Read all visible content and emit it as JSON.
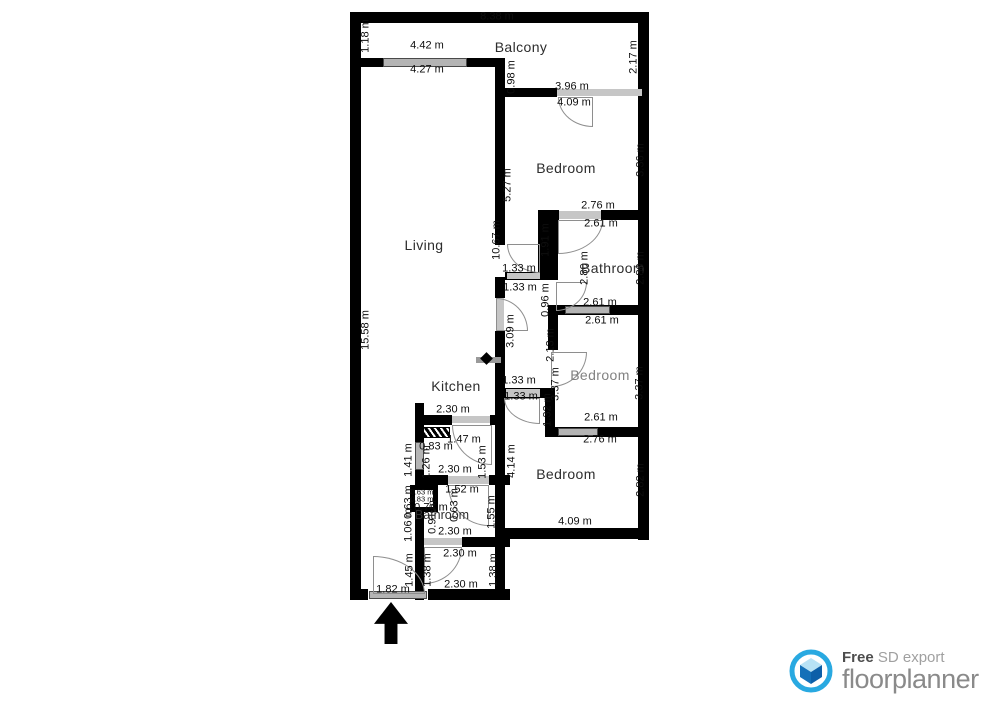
{
  "plan": {
    "labels": [
      {
        "text": "8.38 m",
        "x": 497,
        "y": 17
      },
      {
        "text": "1.18 m",
        "x": 366,
        "y": 36,
        "rot": 1
      },
      {
        "text": "4.42 m",
        "x": 427,
        "y": 46
      },
      {
        "text": "Balcony",
        "x": 521,
        "y": 47,
        "kind": "room"
      },
      {
        "text": "4.27 m",
        "x": 427,
        "y": 70
      },
      {
        "text": "0.98 m",
        "x": 512,
        "y": 77,
        "rot": 1
      },
      {
        "text": "2.17 m",
        "x": 634,
        "y": 57,
        "rot": 1
      },
      {
        "text": "3.96 m",
        "x": 572,
        "y": 87
      },
      {
        "text": "4.09 m",
        "x": 574,
        "y": 103
      },
      {
        "text": "Bedroom",
        "x": 566,
        "y": 168,
        "kind": "room"
      },
      {
        "text": "5.27 m",
        "x": 508,
        "y": 185,
        "rot": 1
      },
      {
        "text": "3.36 m",
        "x": 641,
        "y": 160,
        "rot": 1
      },
      {
        "text": "2.76 m",
        "x": 598,
        "y": 206
      },
      {
        "text": "2.61 m",
        "x": 601,
        "y": 224
      },
      {
        "text": "1.91 m",
        "x": 546,
        "y": 240,
        "rot": 1
      },
      {
        "text": "2.80 m",
        "x": 585,
        "y": 268,
        "rot": 1
      },
      {
        "text": "Bathroom",
        "x": 613,
        "y": 268,
        "kind": "room"
      },
      {
        "text": "2.80 m",
        "x": 641,
        "y": 268,
        "rot": 1
      },
      {
        "text": "10.67 m",
        "x": 497,
        "y": 240,
        "rot": 1
      },
      {
        "text": "1.33 m",
        "x": 519,
        "y": 269
      },
      {
        "text": "1.33 m",
        "x": 520,
        "y": 288
      },
      {
        "text": "2.61 m",
        "x": 600,
        "y": 303
      },
      {
        "text": "2.61 m",
        "x": 602,
        "y": 321
      },
      {
        "text": "0.96 m",
        "x": 546,
        "y": 300,
        "rot": 1
      },
      {
        "text": "3.09 m",
        "x": 511,
        "y": 331,
        "rot": 1
      },
      {
        "text": "2.13 m",
        "x": 551,
        "y": 345,
        "rot": 1
      },
      {
        "text": "15.58 m",
        "x": 366,
        "y": 330,
        "rot": 1
      },
      {
        "text": "Living",
        "x": 424,
        "y": 245,
        "kind": "room"
      },
      {
        "text": "Bedroom",
        "x": 600,
        "y": 375,
        "kind": "room gray"
      },
      {
        "text": "3.37 m",
        "x": 556,
        "y": 384,
        "rot": 1
      },
      {
        "text": "3.37 m",
        "x": 640,
        "y": 383,
        "rot": 1
      },
      {
        "text": "1.33 m",
        "x": 519,
        "y": 381
      },
      {
        "text": "1.33 m",
        "x": 521,
        "y": 397
      },
      {
        "text": "1.32 m",
        "x": 548,
        "y": 410,
        "rot": 1
      },
      {
        "text": "2.61 m",
        "x": 601,
        "y": 418
      },
      {
        "text": "2.76 m",
        "x": 600,
        "y": 440
      },
      {
        "text": "Kitchen",
        "x": 456,
        "y": 386,
        "kind": "room"
      },
      {
        "text": "2.30 m",
        "x": 453,
        "y": 410
      },
      {
        "text": "1.47 m",
        "x": 464,
        "y": 440
      },
      {
        "text": "0.83 m",
        "x": 436,
        "y": 447
      },
      {
        "text": "1.41 m",
        "x": 409,
        "y": 460,
        "rot": 1
      },
      {
        "text": "1.26 m",
        "x": 427,
        "y": 462,
        "rot": 1
      },
      {
        "text": "1.53 m",
        "x": 483,
        "y": 462,
        "rot": 1
      },
      {
        "text": "4.14 m",
        "x": 512,
        "y": 461,
        "rot": 1
      },
      {
        "text": "Bedroom",
        "x": 566,
        "y": 474,
        "kind": "room"
      },
      {
        "text": "2.82 m",
        "x": 641,
        "y": 480,
        "rot": 1
      },
      {
        "text": "2.30 m",
        "x": 455,
        "y": 470
      },
      {
        "text": "1.52 m",
        "x": 462,
        "y": 490
      },
      {
        "text": "0.63 m",
        "x": 455,
        "y": 505,
        "rot": 1
      },
      {
        "text": "1.55 m",
        "x": 492,
        "y": 512,
        "rot": 1
      },
      {
        "text": "0.63 m",
        "x": 409,
        "y": 502,
        "rot": 1
      },
      {
        "text": "1.06 m",
        "x": 409,
        "y": 525,
        "rot": 1
      },
      {
        "text": "0.63 m",
        "x": 422,
        "y": 492,
        "kind": "tiny"
      },
      {
        "text": "0.83 m",
        "x": 422,
        "y": 499,
        "kind": "tiny"
      },
      {
        "text": "0.74 m",
        "x": 431,
        "y": 508
      },
      {
        "text": "0.91 m",
        "x": 433,
        "y": 517,
        "rot": 1
      },
      {
        "text": "Bathroom",
        "x": 442,
        "y": 515,
        "kind": "room-small"
      },
      {
        "text": "2.30 m",
        "x": 455,
        "y": 532
      },
      {
        "text": "4.09 m",
        "x": 575,
        "y": 522
      },
      {
        "text": "2.30 m",
        "x": 460,
        "y": 554
      },
      {
        "text": "1.45 m",
        "x": 410,
        "y": 570,
        "rot": 1
      },
      {
        "text": "1.38 m",
        "x": 428,
        "y": 570,
        "rot": 1
      },
      {
        "text": "1.38 m",
        "x": 494,
        "y": 570,
        "rot": 1
      },
      {
        "text": "2.30 m",
        "x": 461,
        "y": 585
      },
      {
        "text": "1.82 m",
        "x": 393,
        "y": 590
      }
    ]
  },
  "footer": {
    "free_word": "Free",
    "export_text": "SD export",
    "brand": "floorplanner"
  },
  "colors": {
    "wall": "#000000",
    "window_fill": "#b4b4b4",
    "door_arc": "#8e8e8e",
    "logo_blue": "#29a9e1",
    "logo_dark_blue": "#0d5fa8",
    "logo_mid_blue": "#1470b8",
    "logo_light_blue": "#b8e2f5",
    "brand_gray": "#8a8a8a"
  }
}
